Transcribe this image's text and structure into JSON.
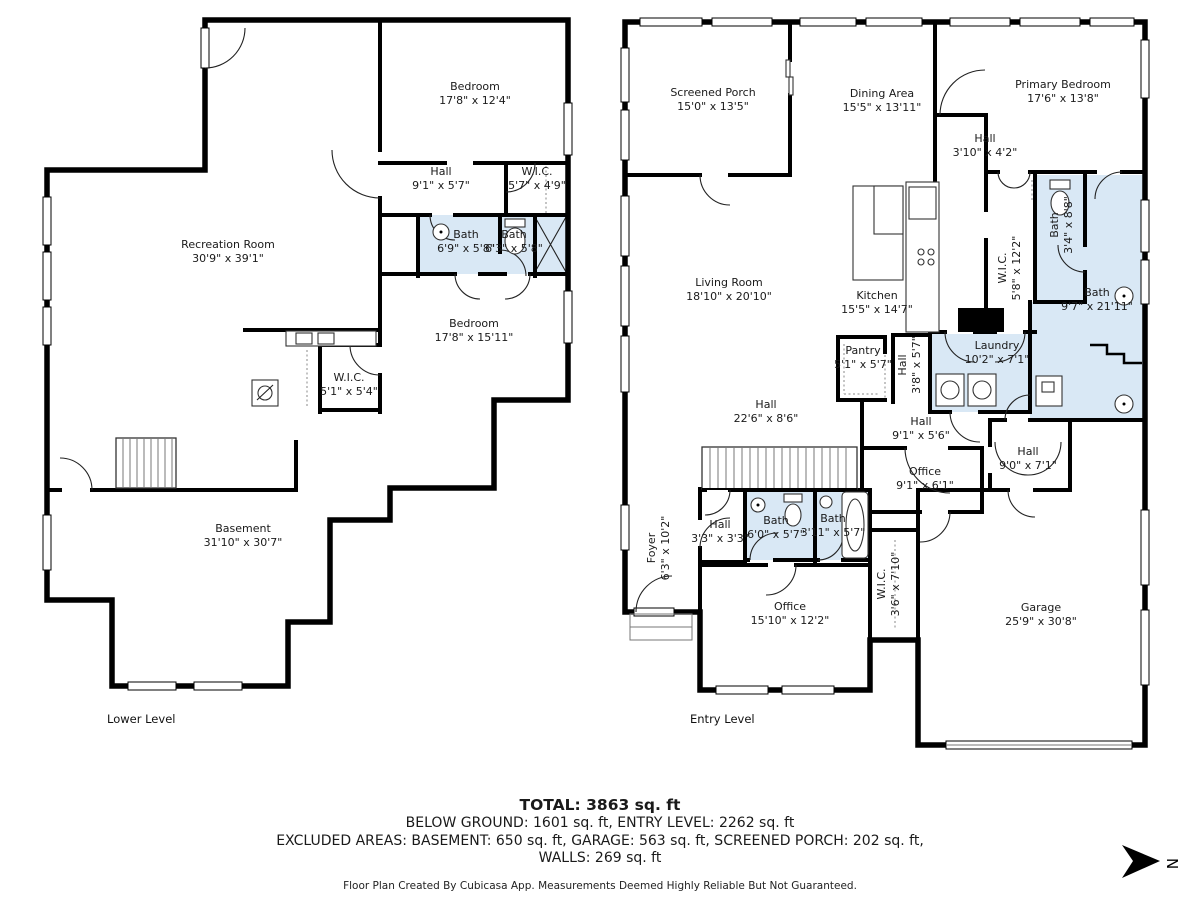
{
  "colors": {
    "wall": "#000000",
    "bath_fill": "#d9e8f5",
    "label": "#1a1a1a"
  },
  "compass": {
    "letter": "N"
  },
  "summary": {
    "total": "TOTAL: 3863 sq. ft",
    "below_line": "BELOW GROUND: 1601 sq. ft, ENTRY LEVEL: 2262 sq. ft",
    "excluded_line1": "EXCLUDED AREAS: BASEMENT: 650 sq. ft, GARAGE: 563 sq. ft, SCREENED PORCH: 202 sq. ft,",
    "excluded_line2": "WALLS: 269 sq. ft",
    "disclaimer": "Floor Plan Created By Cubicasa App. Measurements Deemed Highly Reliable But Not Guaranteed."
  },
  "floors": [
    {
      "name": "Lower Level",
      "label_x": 107,
      "label_y": 712,
      "rooms": [
        {
          "name": "Bedroom",
          "dims": "17'8\" x 12'4\"",
          "x": 475,
          "y": 94
        },
        {
          "name": "Hall",
          "dims": "9'1\" x 5'7\"",
          "x": 441,
          "y": 179
        },
        {
          "name": "W.I.C.",
          "dims": "5'7\" x 4'9\"",
          "x": 537,
          "y": 179
        },
        {
          "name": "Bath",
          "dims": "6'9\" x 5'8\"",
          "x": 466,
          "y": 242
        },
        {
          "name": "Bath",
          "dims": "6'3\" x 5'8\"",
          "x": 514,
          "y": 242
        },
        {
          "name": "Recreation Room",
          "dims": "30'9\" x 39'1\"",
          "x": 228,
          "y": 252
        },
        {
          "name": "Bedroom",
          "dims": "17'8\" x 15'11\"",
          "x": 474,
          "y": 331
        },
        {
          "name": "W.I.C.",
          "dims": "5'1\" x 5'4\"",
          "x": 349,
          "y": 385
        },
        {
          "name": "Basement",
          "dims": "31'10\" x 30'7\"",
          "x": 243,
          "y": 536
        }
      ]
    },
    {
      "name": "Entry Level",
      "label_x": 690,
      "label_y": 712,
      "rooms": [
        {
          "name": "Screened Porch",
          "dims": "15'0\" x 13'5\"",
          "x": 713,
          "y": 100
        },
        {
          "name": "Dining Area",
          "dims": "15'5\" x 13'11\"",
          "x": 882,
          "y": 101
        },
        {
          "name": "Primary Bedroom",
          "dims": "17'6\" x 13'8\"",
          "x": 1063,
          "y": 92
        },
        {
          "name": "Hall",
          "dims": "3'10\" x 4'2\"",
          "x": 985,
          "y": 146
        },
        {
          "name": "Living Room",
          "dims": "18'10\" x 20'10\"",
          "x": 729,
          "y": 290
        },
        {
          "name": "Kitchen",
          "dims": "15'5\" x 14'7\"",
          "x": 877,
          "y": 303
        },
        {
          "name": "Bath",
          "dims": "3'4\" x 8'8\"",
          "x": 1062,
          "y": 225,
          "vertical": true
        },
        {
          "name": "W.I.C.",
          "dims": "5'8\" x 12'2\"",
          "x": 1010,
          "y": 268,
          "vertical": true
        },
        {
          "name": "Bath",
          "dims": "9'7\" x 21'11\"",
          "x": 1097,
          "y": 300
        },
        {
          "name": "Pantry",
          "dims": "5'1\" x 5'7\"",
          "x": 863,
          "y": 358
        },
        {
          "name": "Hall",
          "dims": "3'8\" x 5'7\"",
          "x": 910,
          "y": 365,
          "vertical": true
        },
        {
          "name": "Laundry",
          "dims": "10'2\" x 7'1\"",
          "x": 997,
          "y": 353
        },
        {
          "name": "Hall",
          "dims": "22'6\" x 8'6\"",
          "x": 766,
          "y": 412
        },
        {
          "name": "Hall",
          "dims": "9'1\" x 5'6\"",
          "x": 921,
          "y": 429
        },
        {
          "name": "Office",
          "dims": "9'1\" x 6'1\"",
          "x": 925,
          "y": 479
        },
        {
          "name": "Hall",
          "dims": "9'0\" x 7'1\"",
          "x": 1028,
          "y": 459
        },
        {
          "name": "Foyer",
          "dims": "6'3\" x 10'2\"",
          "x": 659,
          "y": 548,
          "vertical": true
        },
        {
          "name": "Hall",
          "dims": "3'3\" x 3'3\"",
          "x": 720,
          "y": 532
        },
        {
          "name": "Bath",
          "dims": "6'0\" x 5'7\"",
          "x": 776,
          "y": 528
        },
        {
          "name": "Bath",
          "dims": "3'11\" x 5'7\"",
          "x": 833,
          "y": 526
        },
        {
          "name": "W.I.C.",
          "dims": "3'6\" x 7'10\"",
          "x": 889,
          "y": 584,
          "vertical": true
        },
        {
          "name": "Office",
          "dims": "15'10\" x 12'2\"",
          "x": 790,
          "y": 614
        },
        {
          "name": "Garage",
          "dims": "25'9\" x 30'8\"",
          "x": 1041,
          "y": 615
        }
      ]
    }
  ]
}
